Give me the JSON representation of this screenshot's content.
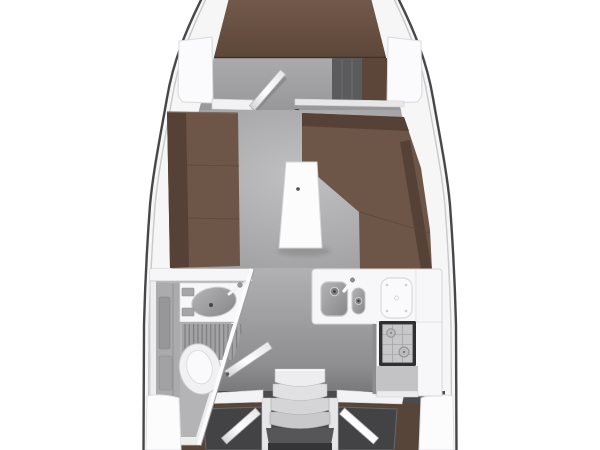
{
  "diagram": {
    "kind": "sailboat-interior-deck-plan-top-view",
    "features": [
      "v-berth",
      "forward-cabin",
      "hanging-locker",
      "forward-cabin-door",
      "mast-post",
      "saloon",
      "port-settee",
      "starboard-l-settee",
      "saloon-table",
      "head-compartment",
      "washbasin",
      "shower-grate",
      "toilet",
      "head-door",
      "galley",
      "double-sink",
      "icebox-lid",
      "stove",
      "galley-cabinet",
      "companionway-steps",
      "port-aft-cabin",
      "starboard-aft-cabin",
      "aft-cabin-doors",
      "side-decks",
      "hull-outline"
    ]
  },
  "palette": {
    "background": "#ffffff",
    "hull_line": "#47474a",
    "deck": "#f6f6f7",
    "deck_inner_line": "#c9c9cb",
    "fwd_sole": "#a7a7a9",
    "saloon_sole": "#adadaf",
    "walk_sole": "#9c9c9e",
    "aft_sole": "#4b4b4d",
    "upholstery": "#6d5547",
    "upholstery_dark": "#554136",
    "locker_gray": "#5b5b5d",
    "aft_floor_brown": "#57453a",
    "berth_dark": "#434345",
    "fixture_white": "#f7f7f9",
    "stainless": "#9b9b9d",
    "stove_frame": "#302f31",
    "step_light": "#ededef",
    "companionway_base": "#565658"
  }
}
